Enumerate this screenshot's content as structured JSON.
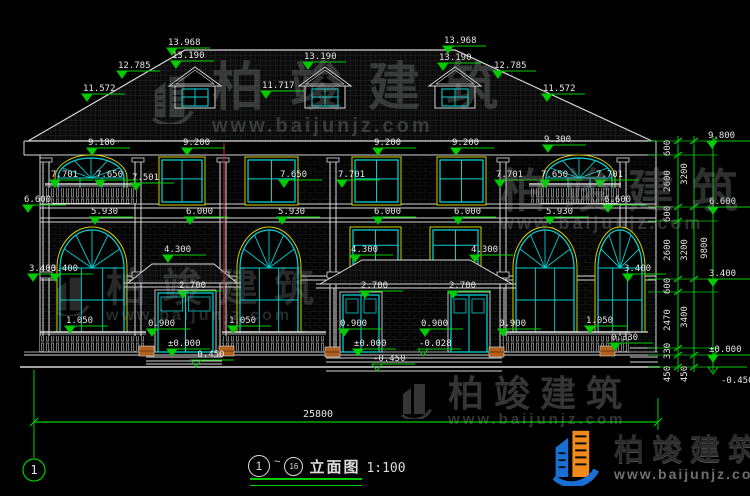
{
  "meta": {
    "bg": "#000000",
    "line_white": "#d8d8d8",
    "dim_green": "#00cc00",
    "window_cyan": "#00d2d2",
    "trim_yellow": "#d2d200",
    "section_red": "#c02020",
    "planter_orange": "#b26020",
    "text_white": "#e6e6e6"
  },
  "watermark": {
    "brand": "柏竣建筑",
    "site": "www.baijunjz.com"
  },
  "corner_logo": {
    "brand": "柏竣建筑",
    "site": "www.baijunjz.com"
  },
  "axis_bubble": "1",
  "bottom_dim": "25800",
  "title_block": {
    "bubble_left": "1",
    "separator": "~",
    "bubble_right": "16",
    "title": "立面图",
    "scale": "1:100"
  },
  "elevation_flags": [
    {
      "t": "13.968",
      "x": 172,
      "y": 55
    },
    {
      "t": "13.190",
      "x": 176,
      "y": 68
    },
    {
      "t": "13.190",
      "x": 308,
      "y": 69
    },
    {
      "t": "13.968",
      "x": 448,
      "y": 53
    },
    {
      "t": "13.190",
      "x": 443,
      "y": 70
    },
    {
      "t": "12.785",
      "x": 122,
      "y": 78
    },
    {
      "t": "12.785",
      "x": 498,
      "y": 78
    },
    {
      "t": "11.572",
      "x": 87,
      "y": 101
    },
    {
      "t": "11.717",
      "x": 266,
      "y": 98
    },
    {
      "t": "11.572",
      "x": 547,
      "y": 101
    },
    {
      "t": "9.180",
      "x": 92,
      "y": 155
    },
    {
      "t": "9.200",
      "x": 187,
      "y": 155
    },
    {
      "t": "9.200",
      "x": 378,
      "y": 155
    },
    {
      "t": "9.200",
      "x": 456,
      "y": 155
    },
    {
      "t": "9.300",
      "x": 548,
      "y": 152
    },
    {
      "t": "7.701",
      "x": 55,
      "y": 187
    },
    {
      "t": "7.650",
      "x": 100,
      "y": 187
    },
    {
      "t": "7.501",
      "x": 136,
      "y": 190
    },
    {
      "t": "7.650",
      "x": 284,
      "y": 187
    },
    {
      "t": "7.701",
      "x": 342,
      "y": 187
    },
    {
      "t": "7.701",
      "x": 500,
      "y": 187
    },
    {
      "t": "7.650",
      "x": 545,
      "y": 187
    },
    {
      "t": "7.701",
      "x": 600,
      "y": 187
    },
    {
      "t": "6.600",
      "x": 28,
      "y": 212
    },
    {
      "t": "6.600",
      "x": 608,
      "y": 212
    },
    {
      "t": "5.930",
      "x": 95,
      "y": 224
    },
    {
      "t": "6.000",
      "x": 190,
      "y": 224
    },
    {
      "t": "5.930",
      "x": 282,
      "y": 224
    },
    {
      "t": "6.000",
      "x": 378,
      "y": 224
    },
    {
      "t": "6.000",
      "x": 458,
      "y": 224
    },
    {
      "t": "5.930",
      "x": 550,
      "y": 224
    },
    {
      "t": "4.300",
      "x": 168,
      "y": 262
    },
    {
      "t": "4.300",
      "x": 355,
      "y": 262
    },
    {
      "t": "4.300",
      "x": 475,
      "y": 262
    },
    {
      "t": "3.400",
      "x": 33,
      "y": 281
    },
    {
      "t": "3.400",
      "x": 55,
      "y": 281
    },
    {
      "t": "3.400",
      "x": 628,
      "y": 281
    },
    {
      "t": "2.700",
      "x": 183,
      "y": 298
    },
    {
      "t": "2.700",
      "x": 365,
      "y": 298
    },
    {
      "t": "2.700",
      "x": 453,
      "y": 298
    },
    {
      "t": "1.050",
      "x": 70,
      "y": 333
    },
    {
      "t": "1.050",
      "x": 233,
      "y": 333
    },
    {
      "t": "1.050",
      "x": 590,
      "y": 333
    },
    {
      "t": "0.900",
      "x": 152,
      "y": 336
    },
    {
      "t": "0.900",
      "x": 344,
      "y": 336
    },
    {
      "t": "0.900",
      "x": 425,
      "y": 336
    },
    {
      "t": "0.900",
      "x": 503,
      "y": 336
    },
    {
      "t": "0.330",
      "x": 615,
      "y": 350
    },
    {
      "t": "±0.000",
      "x": 172,
      "y": 356
    },
    {
      "t": "±0.000",
      "x": 358,
      "y": 356
    },
    {
      "t": "-0.028",
      "x": 423,
      "y": 356,
      "open": true
    },
    {
      "t": "-0.450",
      "x": 196,
      "y": 367,
      "open": true
    },
    {
      "t": "-0.450",
      "x": 377,
      "y": 371,
      "open": true
    },
    {
      "t": "9.800",
      "x": 712,
      "y": 148
    },
    {
      "t": "6.600",
      "x": 713,
      "y": 214
    },
    {
      "t": "3.400",
      "x": 713,
      "y": 286
    },
    {
      "t": "±0.000",
      "x": 713,
      "y": 362
    },
    {
      "t": "-0.450",
      "x": 713,
      "y": 367,
      "open": true,
      "below": true
    }
  ],
  "right_chain": {
    "lines": [
      {
        "x": 678,
        "ticks": [
          141,
          155,
          207,
          221,
          279,
          292,
          348,
          355,
          367
        ]
      },
      {
        "x": 694,
        "ticks": [
          141,
          207,
          279,
          355,
          367
        ]
      },
      {
        "x": 713,
        "ticks": [
          141,
          355
        ]
      }
    ],
    "connector_levels": [
      141,
      155,
      207,
      221,
      279,
      292,
      348,
      355,
      367
    ],
    "labels": [
      {
        "t": "600",
        "x": 670,
        "y": 148
      },
      {
        "t": "2600",
        "x": 670,
        "y": 181
      },
      {
        "t": "600",
        "x": 670,
        "y": 214
      },
      {
        "t": "2600",
        "x": 670,
        "y": 250
      },
      {
        "t": "600",
        "x": 670,
        "y": 286
      },
      {
        "t": "2470",
        "x": 670,
        "y": 320
      },
      {
        "t": "330",
        "x": 670,
        "y": 351
      },
      {
        "t": "450",
        "x": 670,
        "y": 374
      },
      {
        "t": "3200",
        "x": 687,
        "y": 174
      },
      {
        "t": "3200",
        "x": 687,
        "y": 250
      },
      {
        "t": "3400",
        "x": 687,
        "y": 317
      },
      {
        "t": "450",
        "x": 687,
        "y": 374
      },
      {
        "t": "9800",
        "x": 707,
        "y": 248
      }
    ]
  }
}
